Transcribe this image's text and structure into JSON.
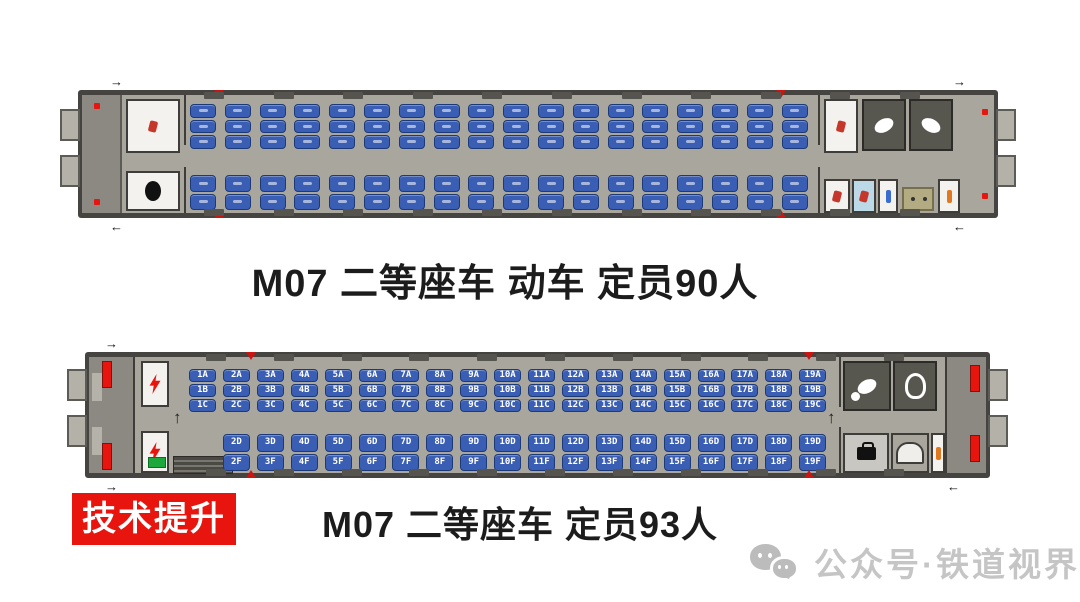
{
  "top_car": {
    "caption": "M07 二等座车 动车 定员90人",
    "car_code": "M07",
    "car_type": "二等座车 动车",
    "capacity": "90",
    "layout": {
      "upper_groups": 18,
      "upper_seats_per_group": 3,
      "lower_groups": 18,
      "lower_seats_per_group": 2
    }
  },
  "bottom_car": {
    "caption": "M07 二等座车 定员93人",
    "car_code": "M07",
    "car_type": "二等座车",
    "capacity": "93",
    "upper_seat_groups": [
      [
        "1A",
        "1B",
        "1C"
      ],
      [
        "2A",
        "2B",
        "2C"
      ],
      [
        "3A",
        "3B",
        "3C"
      ],
      [
        "4A",
        "4B",
        "4C"
      ],
      [
        "5A",
        "5B",
        "5C"
      ],
      [
        "6A",
        "6B",
        "6C"
      ],
      [
        "7A",
        "7B",
        "7C"
      ],
      [
        "8A",
        "8B",
        "8C"
      ],
      [
        "9A",
        "9B",
        "9C"
      ],
      [
        "10A",
        "10B",
        "10C"
      ],
      [
        "11A",
        "11B",
        "11C"
      ],
      [
        "12A",
        "12B",
        "12C"
      ],
      [
        "13A",
        "13B",
        "13C"
      ],
      [
        "14A",
        "14B",
        "14C"
      ],
      [
        "15A",
        "15B",
        "15C"
      ],
      [
        "16A",
        "16B",
        "16C"
      ],
      [
        "17A",
        "17B",
        "17C"
      ],
      [
        "18A",
        "18B",
        "18C"
      ],
      [
        "19A",
        "19B",
        "19C"
      ]
    ],
    "lower_seat_groups": [
      [
        "2D",
        "2F"
      ],
      [
        "3D",
        "3F"
      ],
      [
        "4D",
        "4F"
      ],
      [
        "5D",
        "5F"
      ],
      [
        "6D",
        "6F"
      ],
      [
        "7D",
        "7F"
      ],
      [
        "8D",
        "8F"
      ],
      [
        "9D",
        "9F"
      ],
      [
        "10D",
        "10F"
      ],
      [
        "11D",
        "11F"
      ],
      [
        "12D",
        "12F"
      ],
      [
        "13D",
        "13F"
      ],
      [
        "14D",
        "14F"
      ],
      [
        "15D",
        "15F"
      ],
      [
        "16D",
        "16F"
      ],
      [
        "17D",
        "17F"
      ],
      [
        "18D",
        "18F"
      ],
      [
        "19D",
        "19F"
      ]
    ]
  },
  "badge": {
    "label": "技术提升"
  },
  "watermark": {
    "label": "公众号·铁道视界",
    "icon": "wechat-icon"
  },
  "colors": {
    "seat_blue": "#3a5eb4",
    "seat_border": "#1c3a78",
    "seat_label": "#ffffff",
    "floor": "#a9a69e",
    "wall": "#454440",
    "room_dark": "#57564f",
    "accent_red": "#e8150f"
  }
}
